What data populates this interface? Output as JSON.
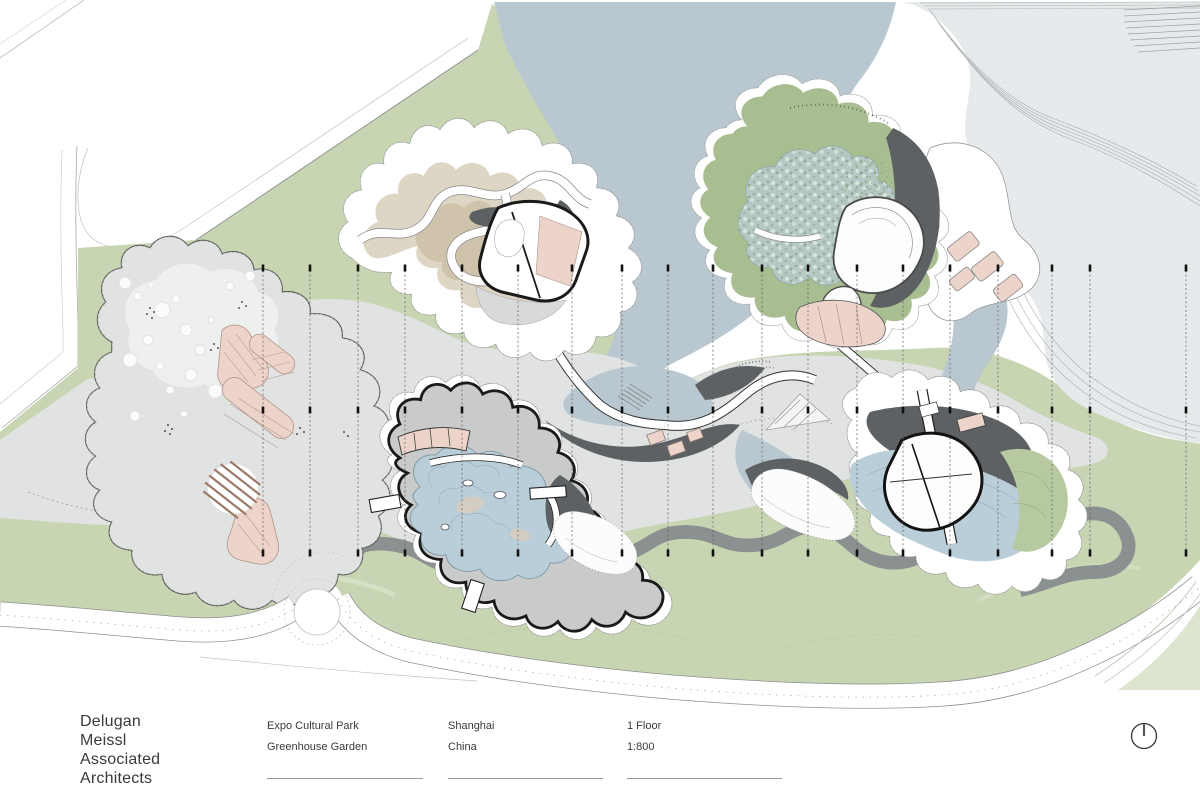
{
  "title_block": {
    "firm_name": "Delugan\nMeissl\nAssociated\nArchitects",
    "project": {
      "line1": "Expo Cultural Park",
      "line2": "Greenhouse Garden"
    },
    "location": {
      "line1": "Shanghai",
      "line2": "China"
    },
    "sheet": {
      "line1": "1 Floor",
      "line2": "1:800"
    },
    "north_icon": "north-arrow"
  },
  "plan": {
    "section_line_xs": [
      263,
      310,
      358,
      405,
      462,
      518,
      572,
      622,
      668,
      713,
      762,
      808,
      857,
      903,
      950,
      998,
      1052,
      1090,
      1186
    ],
    "marker_rows": [
      268,
      410,
      553
    ],
    "section_top": 266,
    "section_bottom": 556,
    "palette": {
      "ink": "#3a3a3a",
      "line": "#9aa0a2",
      "green": "#c7d5b2",
      "green-pale": "#dce6cf",
      "sgreen": "#a8bd90",
      "hill": "#b7c9a1",
      "lake": "#b9c8d0",
      "shore": "#e7ebec",
      "pond": "#b9ced9",
      "pondtex": "#b5c8c4",
      "plaza": "#e1e3e3",
      "plaza-light": "#eef0ef",
      "deck": "#c9cbcb",
      "dark": "#5d6163",
      "tan1": "#ded6c5",
      "tan2": "#cfc4ab",
      "pink": "#ecd4cb",
      "pinkline": "#b1948a",
      "brown": "#9b7a6a",
      "outline": "#1a1a1a"
    }
  }
}
